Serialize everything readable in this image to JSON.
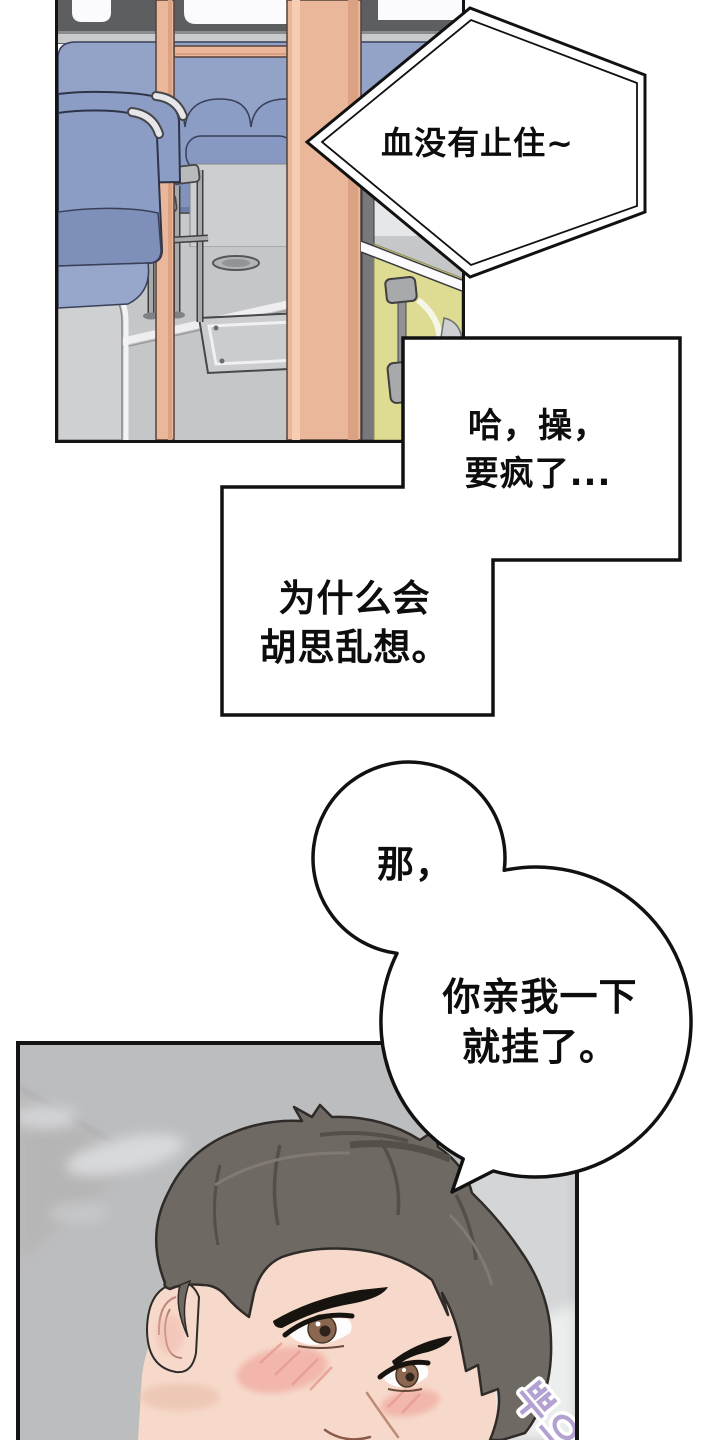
{
  "comic": {
    "bubble_hex": {
      "text": "血没有止住~"
    },
    "bubble_rect_a": {
      "line1": "哈，操，",
      "line2": "要疯了..."
    },
    "bubble_rect_b": {
      "line1": "为什么会",
      "line2": "胡思乱想。"
    },
    "bubble_cloud": {
      "small": "那，",
      "line1": "你亲我一下",
      "line2": "就挂了。"
    },
    "sfx": {
      "text": "뿌으"
    }
  },
  "colors": {
    "panel_border": "#141414",
    "seat_blue": "#8c9dc5",
    "seat_blue_dark": "#7e90ba",
    "pole_tan": "#eab79a",
    "seat_yellow": "#dedc92",
    "floor_gray": "#c5c6c8",
    "ceiling_gray": "#bcbdbf",
    "hair_brown": "#6f6963",
    "skin": "#f6d9ca",
    "blush_pink": "#f2b3a9",
    "iris_brown": "#8a6750",
    "sfx_purple": "#b2a1d1"
  }
}
